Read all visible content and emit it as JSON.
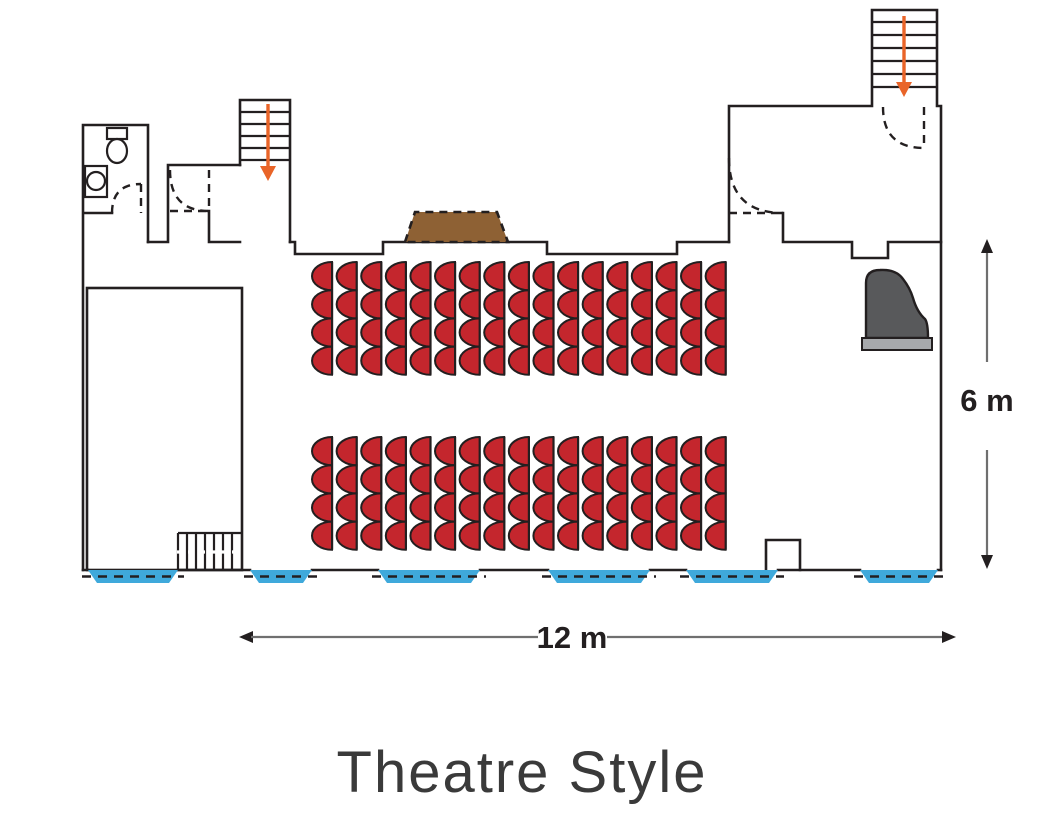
{
  "title": "Theatre Style",
  "dimensions": {
    "width_label": "12 m",
    "height_label": "6 m"
  },
  "colors": {
    "wall": "#231F20",
    "seat": "#C4262D",
    "stage": "#F7A643",
    "podium": "#8E6134",
    "window": "#3FA9DB",
    "stair_arrow": "#E96428",
    "piano_body": "#58595B",
    "piano_keys": "#A7A9AC",
    "stage_arrow": "#FFFFFF"
  },
  "seating": {
    "style": "theatre",
    "total_seats": 136,
    "blocks": [
      {
        "name": "front-block",
        "columns": 17,
        "seats_per_column": 4,
        "x": 312,
        "y": 262,
        "col_pitch": 24.6,
        "row_pitch": 28.2,
        "dome_w": 20
      },
      {
        "name": "rear-block",
        "columns": 17,
        "seats_per_column": 4,
        "x": 312,
        "y": 437,
        "col_pitch": 24.6,
        "row_pitch": 28.2,
        "dome_w": 20
      }
    ]
  },
  "windows": [
    {
      "x": 88,
      "w": 90
    },
    {
      "x": 250,
      "w": 62
    },
    {
      "x": 378,
      "w": 102
    },
    {
      "x": 548,
      "w": 102
    },
    {
      "x": 686,
      "w": 92
    },
    {
      "x": 860,
      "w": 78
    }
  ],
  "features": {
    "stage": "stage-platform",
    "stage_steps": "stage-steps-with-arrow",
    "podium": "lectern-podium",
    "piano": "grand-piano",
    "wc": "toilet-room",
    "stairs_top_left": {
      "treads": 5,
      "direction": "down"
    },
    "stairs_top_right": {
      "treads": 6,
      "direction": "down"
    }
  }
}
